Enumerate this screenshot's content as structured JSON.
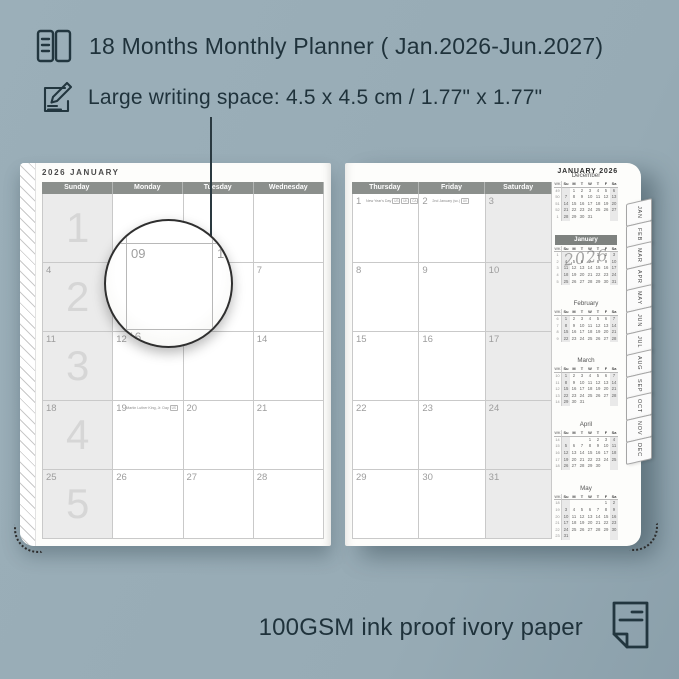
{
  "colors": {
    "background": "#97abb5",
    "ink": "#1f323b",
    "day_header_bar": "#8b8f8c",
    "weekend_fill": "#ebebeb",
    "mini_highlight_bar": "#7e827f"
  },
  "header": {
    "line1": "18 Months Monthly Planner ( Jan.2026-Jun.2027)",
    "line1_icon": "planner-book-icon",
    "line2": "Large writing space: 4.5 x 4.5 cm / 1.77\" x 1.77\"",
    "line2_icon": "pencil-writing-icon"
  },
  "footer": {
    "text": "100GSM ink proof ivory paper",
    "icon": "paper-sheet-icon"
  },
  "planner": {
    "left_page": {
      "title": "2026 JANUARY",
      "day_headers": [
        "Sunday",
        "Monday",
        "Tuesday",
        "Wednesday"
      ],
      "week_numbers": [
        "1",
        "2",
        "3",
        "4",
        "5"
      ],
      "weeks": [
        [
          "",
          "",
          "",
          ""
        ],
        [
          "4",
          "5",
          "6",
          "7"
        ],
        [
          "11",
          "12",
          "13",
          "14"
        ],
        [
          "18",
          "19",
          "20",
          "21"
        ],
        [
          "25",
          "26",
          "27",
          "28"
        ]
      ],
      "events": [
        {
          "date": "19",
          "label": "Martin Luther King, Jr. Day",
          "badges": [
            "US"
          ]
        }
      ]
    },
    "right_page": {
      "title": "JANUARY 2026",
      "day_headers": [
        "Thursday",
        "Friday",
        "Saturday"
      ],
      "weeks": [
        [
          "1",
          "2",
          "3"
        ],
        [
          "8",
          "9",
          "10"
        ],
        [
          "15",
          "16",
          "17"
        ],
        [
          "22",
          "23",
          "24"
        ],
        [
          "29",
          "30",
          "31"
        ]
      ],
      "events": [
        {
          "date": "1",
          "label": "New Year's Day",
          "badges": [
            "US",
            "UK",
            "CA",
            "AU",
            "NZ"
          ]
        },
        {
          "date": "2",
          "label": "2nd January (sc.)",
          "badges": [
            "UK"
          ]
        }
      ]
    },
    "magnifier": {
      "zoom_date": "09",
      "neighbor_right": "10",
      "neighbor_below": "16",
      "underlying_date": "12"
    },
    "sidebar": {
      "title": "JANUARY 2026",
      "watermark": "2026",
      "day_header": [
        "WK",
        "Su",
        "M",
        "T",
        "W",
        "T",
        "F",
        "Sa"
      ],
      "months": [
        {
          "name": "December",
          "highlight": false,
          "rows": [
            [
              "49",
              "",
              "1",
              "2",
              "3",
              "4",
              "5",
              "6"
            ],
            [
              "50",
              "7",
              "8",
              "9",
              "10",
              "11",
              "12",
              "13"
            ],
            [
              "51",
              "14",
              "15",
              "16",
              "17",
              "18",
              "19",
              "20"
            ],
            [
              "52",
              "21",
              "22",
              "23",
              "24",
              "25",
              "26",
              "27"
            ],
            [
              "1",
              "28",
              "29",
              "30",
              "31",
              "",
              "",
              ""
            ]
          ]
        },
        {
          "name": "January",
          "highlight": true,
          "rows": [
            [
              "1",
              "",
              "",
              "",
              "",
              "1",
              "2",
              "3"
            ],
            [
              "2",
              "4",
              "5",
              "6",
              "7",
              "8",
              "9",
              "10"
            ],
            [
              "3",
              "11",
              "12",
              "13",
              "14",
              "15",
              "16",
              "17"
            ],
            [
              "4",
              "18",
              "19",
              "20",
              "21",
              "22",
              "23",
              "24"
            ],
            [
              "5",
              "25",
              "26",
              "27",
              "28",
              "29",
              "30",
              "31"
            ]
          ]
        },
        {
          "name": "February",
          "highlight": false,
          "rows": [
            [
              "6",
              "1",
              "2",
              "3",
              "4",
              "5",
              "6",
              "7"
            ],
            [
              "7",
              "8",
              "9",
              "10",
              "11",
              "12",
              "13",
              "14"
            ],
            [
              "8",
              "15",
              "16",
              "17",
              "18",
              "19",
              "20",
              "21"
            ],
            [
              "9",
              "22",
              "23",
              "24",
              "25",
              "26",
              "27",
              "28"
            ]
          ]
        },
        {
          "name": "March",
          "highlight": false,
          "rows": [
            [
              "10",
              "1",
              "2",
              "3",
              "4",
              "5",
              "6",
              "7"
            ],
            [
              "11",
              "8",
              "9",
              "10",
              "11",
              "12",
              "13",
              "14"
            ],
            [
              "12",
              "15",
              "16",
              "17",
              "18",
              "19",
              "20",
              "21"
            ],
            [
              "13",
              "22",
              "23",
              "24",
              "25",
              "26",
              "27",
              "28"
            ],
            [
              "14",
              "29",
              "30",
              "31",
              "",
              "",
              "",
              ""
            ]
          ]
        },
        {
          "name": "April",
          "highlight": false,
          "rows": [
            [
              "14",
              "",
              "",
              "",
              "1",
              "2",
              "3",
              "4"
            ],
            [
              "15",
              "5",
              "6",
              "7",
              "8",
              "9",
              "10",
              "11"
            ],
            [
              "16",
              "12",
              "13",
              "14",
              "15",
              "16",
              "17",
              "18"
            ],
            [
              "17",
              "19",
              "20",
              "21",
              "22",
              "23",
              "24",
              "25"
            ],
            [
              "18",
              "26",
              "27",
              "28",
              "29",
              "30",
              "",
              ""
            ]
          ]
        },
        {
          "name": "May",
          "highlight": false,
          "rows": [
            [
              "18",
              "",
              "",
              "",
              "",
              "",
              "1",
              "2"
            ],
            [
              "19",
              "3",
              "4",
              "5",
              "6",
              "7",
              "8",
              "9"
            ],
            [
              "20",
              "10",
              "11",
              "12",
              "13",
              "14",
              "15",
              "16"
            ],
            [
              "21",
              "17",
              "18",
              "19",
              "20",
              "21",
              "22",
              "23"
            ],
            [
              "22",
              "24",
              "25",
              "26",
              "27",
              "28",
              "29",
              "30"
            ],
            [
              "23",
              "31",
              "",
              "",
              "",
              "",
              "",
              ""
            ]
          ]
        }
      ]
    },
    "month_tabs": [
      "JAN",
      "FEB",
      "MAR",
      "APR",
      "MAY",
      "JUN",
      "JUL",
      "AUG",
      "SEP",
      "OCT",
      "NOV",
      "DEC"
    ]
  }
}
